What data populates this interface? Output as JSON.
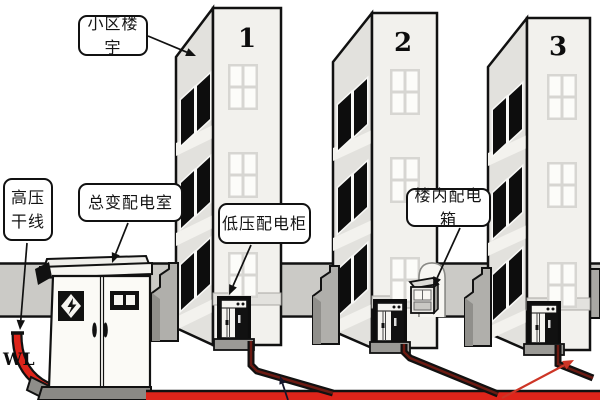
{
  "diagram": {
    "callouts": {
      "community_building": {
        "text": "小区楼宇"
      },
      "hv_trunk": {
        "line1": "高压",
        "line2": "干线"
      },
      "main_transformer_room": {
        "text": "总变配电室"
      },
      "lv_distribution_cabinet": {
        "text": "低压配电柜"
      },
      "indoor_distribution_box": {
        "text": "楼内配电箱"
      }
    },
    "wire_label": "WL",
    "buildings": [
      {
        "number": "1"
      },
      {
        "number": "2"
      },
      {
        "number": "3"
      }
    ],
    "colors": {
      "cable_red": "#de241a",
      "cable_core_dark_red": "#6b1a12",
      "wall_band_gray": "#cbcac6",
      "outline": "#111111"
    }
  }
}
